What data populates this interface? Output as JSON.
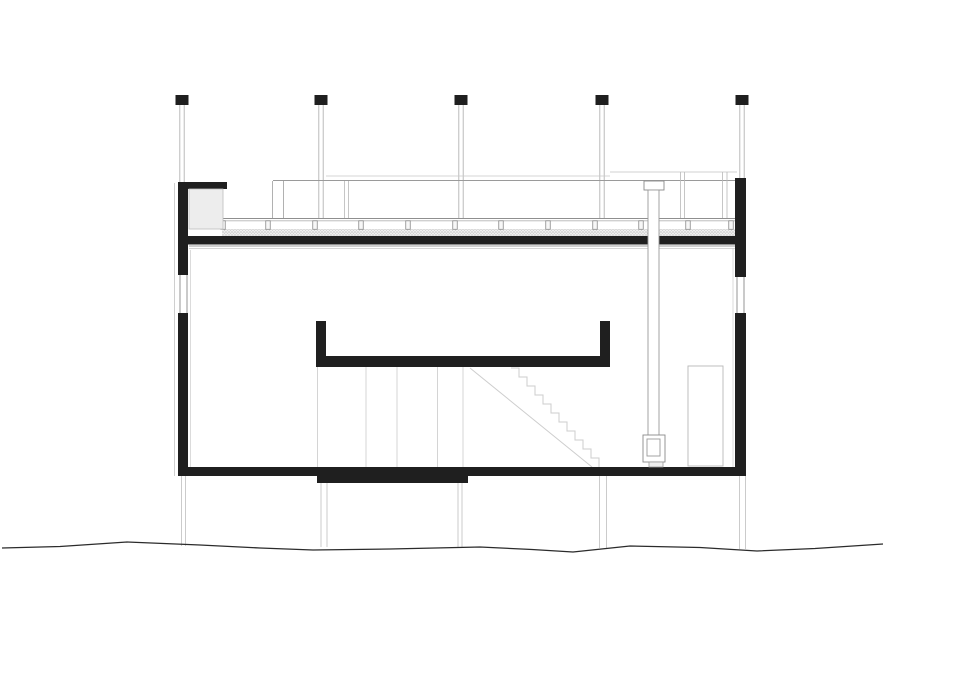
{
  "meta": {
    "description": "Architectural building cross-section drawing, black ink on white",
    "canvas": {
      "width": 960,
      "height": 678,
      "background": "#ffffff"
    }
  },
  "palette": {
    "ink": "#1f1f1f",
    "dark_line": "#2b2b2b",
    "mid_gray": "#8f8f8f",
    "light_gray": "#c6c6c6",
    "very_light_gray": "#d8d8d8",
    "fill_white": "#ffffff",
    "insulation_fill": "#ededed"
  },
  "drawing": {
    "columns": {
      "centers": [
        182,
        321,
        461,
        602,
        742
      ],
      "cap": {
        "y": 95,
        "w": 13,
        "h": 10,
        "fill": "#1f1f1f"
      },
      "line_top": 105,
      "line_bottoms": [
        182,
        218,
        218,
        218,
        178
      ],
      "line_offset": 2.2,
      "line_color": "#b3b3b3",
      "line_width": 0.9
    },
    "lines": [
      {
        "name": "outer-face-left-line",
        "x1": 174.5,
        "y1": 183,
        "x2": 174.5,
        "y2": 476,
        "c": "#cfcfcf",
        "w": 1
      },
      {
        "name": "inner-face-left-line",
        "x1": 190.5,
        "y1": 250,
        "x2": 190.5,
        "y2": 467,
        "c": "#d2d2d2",
        "w": 0.8
      },
      {
        "name": "inner-face-right-line",
        "x1": 733,
        "y1": 248,
        "x2": 733,
        "y2": 467,
        "c": "#d2d2d2",
        "w": 0.8
      },
      {
        "name": "bg-roofline-faint",
        "x1": 326,
        "y1": 176,
        "x2": 610,
        "y2": 176,
        "c": "#c9c9c9",
        "w": 0.8
      },
      {
        "name": "bg-glazing-head-line",
        "x1": 273,
        "y1": 180.5,
        "x2": 737,
        "y2": 180.5,
        "c": "#9a9a9a",
        "w": 1
      },
      {
        "name": "bg-door-head-line",
        "x1": 610,
        "y1": 172,
        "x2": 737,
        "y2": 172,
        "c": "#c0c0c0",
        "w": 0.8
      },
      {
        "name": "glass-joint-line",
        "x1": 272.5,
        "y1": 181,
        "x2": 272.5,
        "y2": 218,
        "c": "#9e9e9e",
        "w": 0.8
      },
      {
        "name": "glass-joint-line",
        "x1": 283.5,
        "y1": 181,
        "x2": 283.5,
        "y2": 218,
        "c": "#9e9e9e",
        "w": 0.8
      },
      {
        "name": "glass-joint-line",
        "x1": 344.5,
        "y1": 181,
        "x2": 344.5,
        "y2": 218,
        "c": "#b8b8b8",
        "w": 0.8
      },
      {
        "name": "glass-joint-line",
        "x1": 348.5,
        "y1": 181,
        "x2": 348.5,
        "y2": 218,
        "c": "#b8b8b8",
        "w": 0.8
      },
      {
        "name": "bg-door-jamb-line",
        "x1": 680.5,
        "y1": 172,
        "x2": 680.5,
        "y2": 218,
        "c": "#b8b8b8",
        "w": 0.8
      },
      {
        "name": "bg-door-jamb-line",
        "x1": 684.5,
        "y1": 172,
        "x2": 684.5,
        "y2": 218,
        "c": "#b8b8b8",
        "w": 0.8
      },
      {
        "name": "bg-door-jamb-line",
        "x1": 722.5,
        "y1": 172,
        "x2": 722.5,
        "y2": 218,
        "c": "#b8b8b8",
        "w": 0.8
      },
      {
        "name": "bg-door-jamb-line",
        "x1": 727,
        "y1": 172,
        "x2": 727,
        "y2": 218,
        "c": "#b8b8b8",
        "w": 0.8
      },
      {
        "name": "deck-surface-line",
        "x1": 222,
        "y1": 218.5,
        "x2": 735,
        "y2": 218.5,
        "c": "#8f8f8f",
        "w": 1
      },
      {
        "name": "deck-surface-line",
        "x1": 222,
        "y1": 220.8,
        "x2": 735,
        "y2": 220.8,
        "c": "#b5b5b5",
        "w": 0.8
      },
      {
        "name": "ceiling-line",
        "x1": 189,
        "y1": 246,
        "x2": 735,
        "y2": 246,
        "c": "#9f9f9f",
        "w": 0.9
      },
      {
        "name": "ceiling-line",
        "x1": 189,
        "y1": 248.5,
        "x2": 735,
        "y2": 248.5,
        "c": "#c9c9c9",
        "w": 0.8
      },
      {
        "name": "interior-elevation-line",
        "x1": 317.5,
        "y1": 367,
        "x2": 317.5,
        "y2": 467,
        "c": "#d0d0d0",
        "w": 0.9
      },
      {
        "name": "interior-elevation-line",
        "x1": 366,
        "y1": 367,
        "x2": 366,
        "y2": 467,
        "c": "#d0d0d0",
        "w": 0.9
      },
      {
        "name": "interior-elevation-line",
        "x1": 397,
        "y1": 367,
        "x2": 397,
        "y2": 467,
        "c": "#d0d0d0",
        "w": 0.9
      },
      {
        "name": "interior-elevation-line",
        "x1": 437.5,
        "y1": 367,
        "x2": 437.5,
        "y2": 467,
        "c": "#d0d0d0",
        "w": 0.9
      },
      {
        "name": "interior-elevation-line",
        "x1": 463,
        "y1": 367,
        "x2": 463,
        "y2": 467,
        "c": "#d0d0d0",
        "w": 0.9
      },
      {
        "name": "stair-stringer-line",
        "x1": 470,
        "y1": 368,
        "x2": 592,
        "y2": 467,
        "c": "#cdcdcd",
        "w": 1
      },
      {
        "name": "window-glazing-line",
        "x1": 180,
        "y1": 275,
        "x2": 180,
        "y2": 313,
        "c": "#8a8a8a",
        "w": 0.9
      },
      {
        "name": "window-glazing-line",
        "x1": 187,
        "y1": 275,
        "x2": 187,
        "y2": 313,
        "c": "#8a8a8a",
        "w": 0.9
      },
      {
        "name": "window-glazing-line",
        "x1": 737,
        "y1": 277,
        "x2": 737,
        "y2": 313,
        "c": "#8a8a8a",
        "w": 0.9
      },
      {
        "name": "window-glazing-line",
        "x1": 744,
        "y1": 277,
        "x2": 744,
        "y2": 313,
        "c": "#8a8a8a",
        "w": 0.9
      },
      {
        "name": "foundation-line",
        "x1": 181.5,
        "y1": 476,
        "x2": 181.5,
        "y2": 546,
        "c": "#c6c6c6",
        "w": 0.9
      },
      {
        "name": "foundation-line",
        "x1": 185.5,
        "y1": 476,
        "x2": 185.5,
        "y2": 546,
        "c": "#c6c6c6",
        "w": 0.9
      },
      {
        "name": "foundation-line",
        "x1": 321,
        "y1": 483,
        "x2": 321,
        "y2": 547,
        "c": "#c6c6c6",
        "w": 0.9
      },
      {
        "name": "foundation-line",
        "x1": 327,
        "y1": 483,
        "x2": 327,
        "y2": 547,
        "c": "#c6c6c6",
        "w": 0.9
      },
      {
        "name": "foundation-line",
        "x1": 458,
        "y1": 483,
        "x2": 458,
        "y2": 547,
        "c": "#c6c6c6",
        "w": 0.9
      },
      {
        "name": "foundation-line",
        "x1": 462,
        "y1": 483,
        "x2": 462,
        "y2": 547,
        "c": "#c6c6c6",
        "w": 0.9
      },
      {
        "name": "foundation-line",
        "x1": 599.5,
        "y1": 476,
        "x2": 599.5,
        "y2": 548,
        "c": "#c6c6c6",
        "w": 0.9
      },
      {
        "name": "foundation-line",
        "x1": 606.5,
        "y1": 476,
        "x2": 606.5,
        "y2": 548,
        "c": "#c6c6c6",
        "w": 0.9
      },
      {
        "name": "foundation-line",
        "x1": 739.5,
        "y1": 476,
        "x2": 739.5,
        "y2": 549,
        "c": "#c6c6c6",
        "w": 0.9
      },
      {
        "name": "foundation-line",
        "x1": 745.5,
        "y1": 476,
        "x2": 745.5,
        "y2": 549,
        "c": "#c6c6c6",
        "w": 0.9
      }
    ],
    "deck_posts": {
      "xs": [
        223,
        268,
        315,
        361,
        408,
        455,
        501,
        548,
        595,
        641,
        688,
        731
      ],
      "y": 220.8,
      "w": 4.5,
      "h": 8.5,
      "stroke": "#8a8a8a",
      "fill": "#f7f7f7"
    },
    "speckle_band": {
      "name": "gravel-band",
      "x": 222,
      "y": 229,
      "w": 513,
      "h": 7
    },
    "black_rects": [
      {
        "name": "parapet-cap-flange",
        "x": 178,
        "y": 182,
        "w": 49,
        "h": 7
      },
      {
        "name": "left-wall-upper",
        "x": 178,
        "y": 182,
        "w": 10,
        "h": 93
      },
      {
        "name": "left-wall-lower",
        "x": 178,
        "y": 313,
        "w": 10,
        "h": 163
      },
      {
        "name": "right-wall-upper",
        "x": 735,
        "y": 178,
        "w": 11,
        "h": 99
      },
      {
        "name": "right-wall-lower",
        "x": 735,
        "y": 313,
        "w": 11,
        "h": 163
      },
      {
        "name": "roof-slab",
        "x": 178,
        "y": 236,
        "w": 568,
        "h": 8.5
      },
      {
        "name": "floor-slab",
        "x": 178,
        "y": 467,
        "w": 568,
        "h": 9
      },
      {
        "name": "floor-slab-thickening",
        "x": 317,
        "y": 467,
        "w": 151,
        "h": 16
      },
      {
        "name": "stair-well-left-stub",
        "x": 316,
        "y": 321,
        "w": 10,
        "h": 46
      },
      {
        "name": "stair-well-right-stub",
        "x": 600,
        "y": 321,
        "w": 10,
        "h": 46
      },
      {
        "name": "stair-well-bottom-bar",
        "x": 316,
        "y": 356,
        "w": 294,
        "h": 11
      }
    ],
    "outlined_rects": [
      {
        "name": "insulation-block",
        "x": 189,
        "y": 189,
        "w": 34,
        "h": 40,
        "fill": "#ededed",
        "stroke": "#bdbdbd",
        "sw": 0.8
      },
      {
        "name": "chimney-cap",
        "x": 644,
        "y": 181,
        "w": 20,
        "h": 9,
        "fill": "#ffffff",
        "stroke": "#8a8a8a",
        "sw": 0.9
      },
      {
        "name": "chimney-flue",
        "x": 648,
        "y": 190,
        "w": 11,
        "h": 246,
        "fill": "#ffffff",
        "stroke": "#9a9a9a",
        "sw": 0.9
      },
      {
        "name": "stove-body",
        "x": 643,
        "y": 435,
        "w": 22,
        "h": 27,
        "fill": "#ffffff",
        "stroke": "#8a8a8a",
        "sw": 0.9
      },
      {
        "name": "stove-firebox",
        "x": 647,
        "y": 439,
        "w": 13,
        "h": 17,
        "fill": "none",
        "stroke": "#9a9a9a",
        "sw": 0.9
      },
      {
        "name": "stove-base",
        "x": 649,
        "y": 462,
        "w": 14,
        "h": 5,
        "fill": "#f0f0f0",
        "stroke": "#9a9a9a",
        "sw": 0.8
      },
      {
        "name": "background-door",
        "x": 688,
        "y": 366,
        "w": 35,
        "h": 100,
        "fill": "none",
        "stroke": "#b8b8b8",
        "sw": 0.9
      }
    ],
    "stairs": {
      "start_x": 511,
      "start_y": 368,
      "tread": 8,
      "riser": 9,
      "count": 11,
      "color": "#cdcdcd",
      "width": 1
    },
    "terrain": {
      "color": "#2b2b2b",
      "width": 1.3,
      "points": [
        [
          2,
          548
        ],
        [
          60,
          546.5
        ],
        [
          127,
          542
        ],
        [
          200,
          545
        ],
        [
          260,
          548
        ],
        [
          313,
          550
        ],
        [
          390,
          549
        ],
        [
          480,
          547
        ],
        [
          532,
          549.5
        ],
        [
          573,
          552
        ],
        [
          630,
          546
        ],
        [
          700,
          547.5
        ],
        [
          757,
          551
        ],
        [
          815,
          548.5
        ],
        [
          883,
          544
        ]
      ]
    }
  }
}
